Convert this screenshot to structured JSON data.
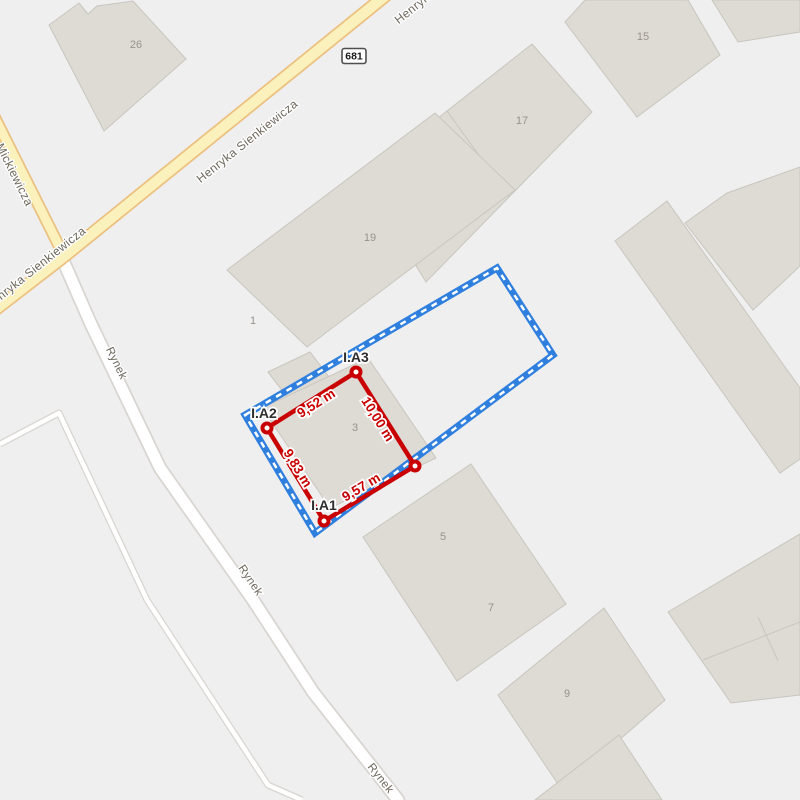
{
  "map": {
    "background_color": "#efefef",
    "building_fill": "#dedad4",
    "building_stroke": "#c9c5bf",
    "building_label_color": "#98928b",
    "road_label_color": "#6d675b",
    "yellow_road_fill": "#fbf1bc",
    "yellow_road_casing": "#ecc07f",
    "white_road_fill": "#ffffff",
    "white_road_casing": "#d8d5d1",
    "roads_yellow": [
      {
        "name": "henryka-sienkiewicza",
        "points": [
          [
            390,
            -8
          ],
          [
            62,
            258
          ],
          [
            -8,
            312
          ]
        ],
        "width": 10.5,
        "casing_width": 14
      },
      {
        "name": "adama-mickiewicza",
        "points": [
          [
            -6,
            116
          ],
          [
            62,
            252
          ]
        ],
        "width": 9,
        "casing_width": 12.5
      }
    ],
    "roads_white": [
      {
        "name": "rynek",
        "points": [
          [
            62,
            258
          ],
          [
            90,
            322
          ],
          [
            160,
            468
          ],
          [
            253,
            600
          ],
          [
            313,
            692
          ],
          [
            398,
            800
          ]
        ],
        "width": 11,
        "casing_width": 14.5
      }
    ],
    "parcel_lines": [
      {
        "name": "market-square-boundary",
        "points": [
          [
            0,
            444
          ],
          [
            59,
            413
          ],
          [
            147,
            600
          ],
          [
            268,
            785
          ],
          [
            302,
            800
          ]
        ],
        "width": 4.5,
        "casing_width": 7
      }
    ],
    "route_badge": {
      "text": "681",
      "x": 354,
      "y": 56,
      "border_color": "#4f4f4f",
      "text_color": "#1a1a1a"
    },
    "road_labels": [
      {
        "text": "Henryka Sienkiewicza",
        "x": 247,
        "y": 141,
        "angle": -38.6,
        "size": 12
      },
      {
        "text": "Henryka Sienkiewicza",
        "x": 445,
        "y": -18,
        "angle": -38.6,
        "size": 12
      },
      {
        "text": "Henryka Sienkiewicza",
        "x": 35,
        "y": 268,
        "angle": -38.6,
        "size": 12
      },
      {
        "text": "Adama Mickiewicza",
        "x": 5,
        "y": 155,
        "angle": 63.5,
        "size": 12
      },
      {
        "text": "Rynek",
        "x": 117,
        "y": 363,
        "angle": 64,
        "size": 11.5
      },
      {
        "text": "Rynek",
        "x": 251,
        "y": 580,
        "angle": 56,
        "size": 11.5
      },
      {
        "text": "Rynek",
        "x": 381,
        "y": 778,
        "angle": 52,
        "size": 11.5
      }
    ],
    "buildings": [
      {
        "id": "b26",
        "polygon": [
          [
            49,
            25
          ],
          [
            79,
            3
          ],
          [
            88,
            14
          ],
          [
            97,
            6
          ],
          [
            133,
            1
          ],
          [
            186,
            59
          ],
          [
            104,
            131
          ]
        ]
      },
      {
        "id": "b15",
        "polygon": [
          [
            585,
            0
          ],
          [
            565,
            22
          ],
          [
            637,
            117
          ],
          [
            720,
            55
          ],
          [
            688,
            0
          ]
        ]
      },
      {
        "id": "b-top-right",
        "polygon": [
          [
            712,
            0
          ],
          [
            738,
            42
          ],
          [
            800,
            32
          ],
          [
            800,
            0
          ]
        ]
      },
      {
        "id": "b17",
        "polygon": [
          [
            532,
            44
          ],
          [
            592,
            112
          ],
          [
            426,
            282
          ],
          [
            362,
            178
          ]
        ],
        "dividers": [
          [
            [
              447,
              111
            ],
            [
              509,
              197
            ]
          ]
        ]
      },
      {
        "id": "b19",
        "polygon": [
          [
            227,
            270
          ],
          [
            435,
            113
          ],
          [
            515,
            190
          ],
          [
            307,
            347
          ]
        ]
      },
      {
        "id": "b1",
        "polygon": [
          [
            268,
            372
          ],
          [
            310,
            352
          ],
          [
            345,
            398
          ],
          [
            303,
            418
          ]
        ]
      },
      {
        "id": "b3",
        "polygon": [
          [
            368,
            358
          ],
          [
            436,
            458
          ],
          [
            330,
            508
          ],
          [
            262,
            408
          ]
        ]
      },
      {
        "id": "b5-7",
        "polygon": [
          [
            471,
            464
          ],
          [
            566,
            604
          ],
          [
            457,
            681
          ],
          [
            363,
            537
          ]
        ]
      },
      {
        "id": "b9",
        "polygon": [
          [
            604,
            608
          ],
          [
            665,
            700
          ],
          [
            562,
            790
          ],
          [
            498,
            695
          ]
        ]
      },
      {
        "id": "b-below-9",
        "polygon": [
          [
            619,
            735
          ],
          [
            662,
            800
          ],
          [
            535,
            800
          ]
        ]
      },
      {
        "id": "b-slab-left",
        "polygon": [
          [
            667,
            201
          ],
          [
            615,
            241
          ],
          [
            780,
            473
          ],
          [
            800,
            459
          ],
          [
            800,
            388
          ]
        ]
      },
      {
        "id": "b-slab-right",
        "polygon": [
          [
            727,
            193
          ],
          [
            800,
            167
          ],
          [
            800,
            266
          ],
          [
            783,
            282
          ],
          [
            753,
            310
          ],
          [
            685,
            223
          ]
        ]
      },
      {
        "id": "b-bottom-right-complex",
        "polygon": [
          [
            668,
            612
          ],
          [
            800,
            534
          ],
          [
            800,
            695
          ],
          [
            731,
            703
          ]
        ],
        "dividers": [
          [
            [
              703,
              660
            ],
            [
              800,
              622
            ]
          ],
          [
            [
              758,
              617
            ],
            [
              778,
              661
            ]
          ]
        ]
      }
    ],
    "building_labels": [
      {
        "text": "26",
        "x": 136,
        "y": 44
      },
      {
        "text": "15",
        "x": 643,
        "y": 36
      },
      {
        "text": "17",
        "x": 522,
        "y": 120
      },
      {
        "text": "19",
        "x": 370,
        "y": 237
      },
      {
        "text": "1",
        "x": 253,
        "y": 320
      },
      {
        "text": "3",
        "x": 355,
        "y": 427
      },
      {
        "text": "5",
        "x": 443,
        "y": 536
      },
      {
        "text": "7",
        "x": 491,
        "y": 607
      },
      {
        "text": "9",
        "x": 567,
        "y": 693
      }
    ],
    "overlay": {
      "parcel_boundary": {
        "color": "#2f7fdf",
        "dash_color": "#ffffff",
        "band_width": 7,
        "dash_width": 2.5,
        "dash_pattern": "6 6",
        "polygon": [
          [
            245,
            415
          ],
          [
            497,
            268
          ],
          [
            553,
            355
          ],
          [
            315,
            533
          ]
        ]
      },
      "measured_shape": {
        "color": "#c90101",
        "line_width": 4.5,
        "polygon": [
          [
            267,
            428
          ],
          [
            356,
            372
          ],
          [
            415,
            466
          ],
          [
            324,
            521
          ]
        ],
        "vertices": [
          {
            "id": "I.A2",
            "x": 267,
            "y": 428
          },
          {
            "id": "I.A3",
            "x": 356,
            "y": 372
          },
          {
            "id": "",
            "x": 415,
            "y": 466
          },
          {
            "id": "I.A1",
            "x": 324,
            "y": 521
          }
        ],
        "vertex_labels": [
          {
            "text": "I.A3",
            "x": 356,
            "y": 357
          },
          {
            "text": "I.A2",
            "x": 264,
            "y": 413
          },
          {
            "text": "I.A1",
            "x": 324,
            "y": 505
          }
        ],
        "vertex_label_color": "#2e2e2e",
        "measurements": [
          {
            "text": "9,52 m",
            "x": 316,
            "y": 403,
            "angle": -32.2
          },
          {
            "text": "10,00 m",
            "x": 378,
            "y": 419,
            "angle": 57.9
          },
          {
            "text": "9,83 m",
            "x": 298,
            "y": 468,
            "angle": 58.5
          },
          {
            "text": "9,57 m",
            "x": 361,
            "y": 487,
            "angle": -31.2
          }
        ]
      }
    }
  }
}
